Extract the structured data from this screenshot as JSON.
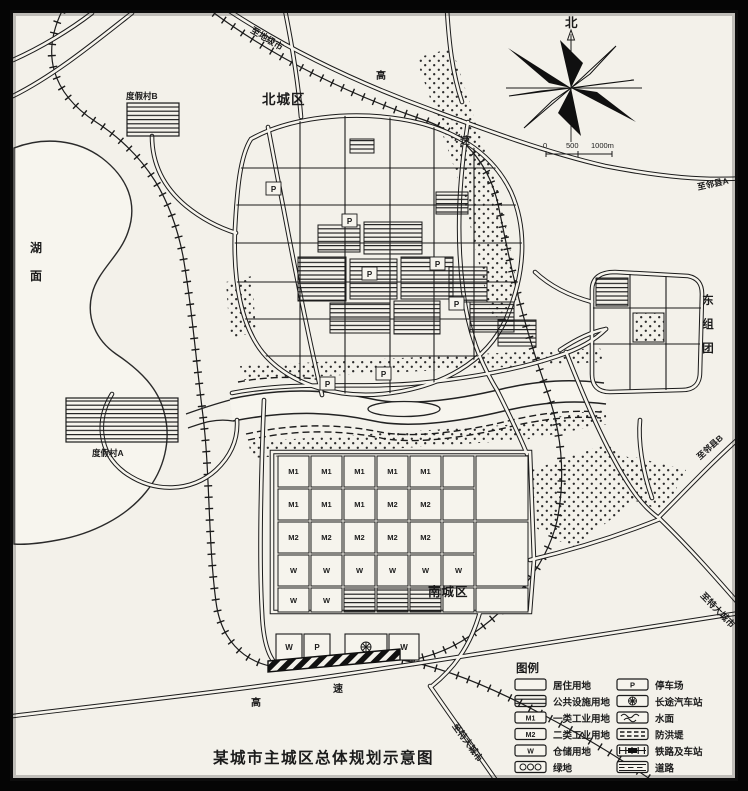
{
  "title": "某城市主城区总体规划示意图",
  "compass": {
    "north": "北"
  },
  "scale": {
    "zero": "0",
    "mid": "500",
    "end": "1000m"
  },
  "regions": {
    "north_district": "北城区",
    "south_district": "南城区",
    "east_cluster": "东组团",
    "east_cluster_chars": [
      "东",
      "组",
      "团"
    ],
    "lake": "湖面",
    "lake_chars": [
      "湖",
      "面"
    ],
    "resort_a": "度假村A",
    "resort_b": "度假村B"
  },
  "roads": {
    "expressway_hi": "高",
    "expressway_su": "速",
    "to_prefecture_city": "至地级市",
    "to_county_a": "至邻县A",
    "to_county_b": "至邻县B",
    "to_metropolis": "至特大城市"
  },
  "block_labels": {
    "m1": "M1",
    "m2": "M2",
    "w": "W",
    "p": "P",
    "bus_station_symbol": "⊕"
  },
  "legend": {
    "title": "图例",
    "left": [
      {
        "symbol": "residential",
        "label": "居住用地"
      },
      {
        "symbol": "public-facilities",
        "label": "公共设施用地"
      },
      {
        "symbol": "industry-class-1",
        "label": "一类工业用地",
        "symbol_text": "M1"
      },
      {
        "symbol": "industry-class-2",
        "label": "二类工业用地",
        "symbol_text": "M2"
      },
      {
        "symbol": "warehouse",
        "label": "仓储用地",
        "symbol_text": "W"
      },
      {
        "symbol": "green-space",
        "label": "绿地"
      }
    ],
    "right": [
      {
        "symbol": "parking",
        "label": "停车场",
        "symbol_text": "P"
      },
      {
        "symbol": "coach-station",
        "label": "长途汽车站"
      },
      {
        "symbol": "water-surface",
        "label": "水面"
      },
      {
        "symbol": "flood-dike",
        "label": "防洪堤"
      },
      {
        "symbol": "railway-and-station",
        "label": "铁路及车站"
      },
      {
        "symbol": "road",
        "label": "道路"
      }
    ]
  },
  "colors": {
    "paper": "#f3f1ea",
    "ink": "#1b1b1b",
    "frame": "#050505"
  }
}
